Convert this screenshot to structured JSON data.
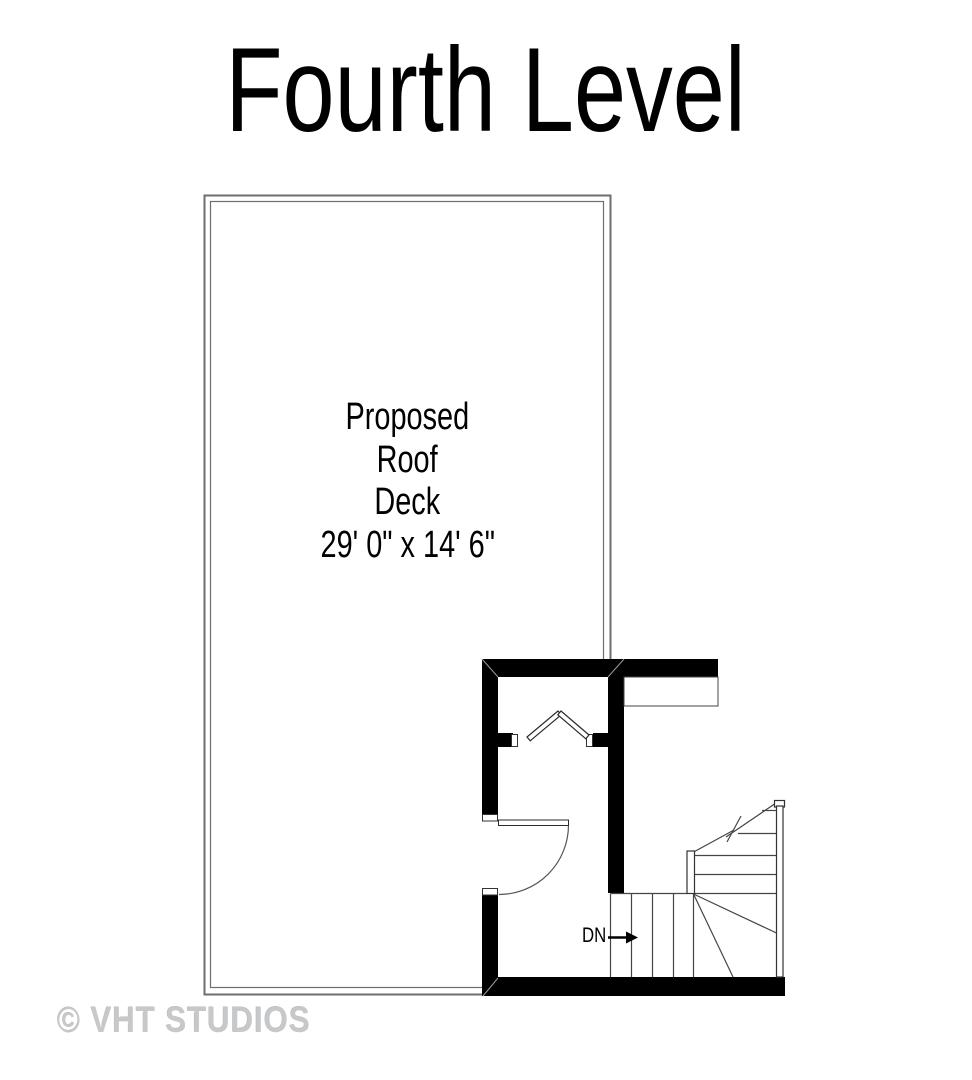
{
  "page": {
    "title": "Fourth Level",
    "watermark": "© VHT STUDIOS"
  },
  "floor_plan": {
    "room": {
      "label_lines": [
        "Proposed",
        "Roof",
        "Deck"
      ],
      "dimensions": "29' 0\" x 14' 6\""
    },
    "stairs": {
      "direction_label": "DN"
    },
    "colors": {
      "wall": "#000000",
      "deck_outline": "#6e6e6e",
      "deck_outline_inner": "#5a5a5a",
      "thin_line": "#454545",
      "door_line": "#2b2b2b",
      "watermark_text": "#c7c8ca"
    }
  }
}
